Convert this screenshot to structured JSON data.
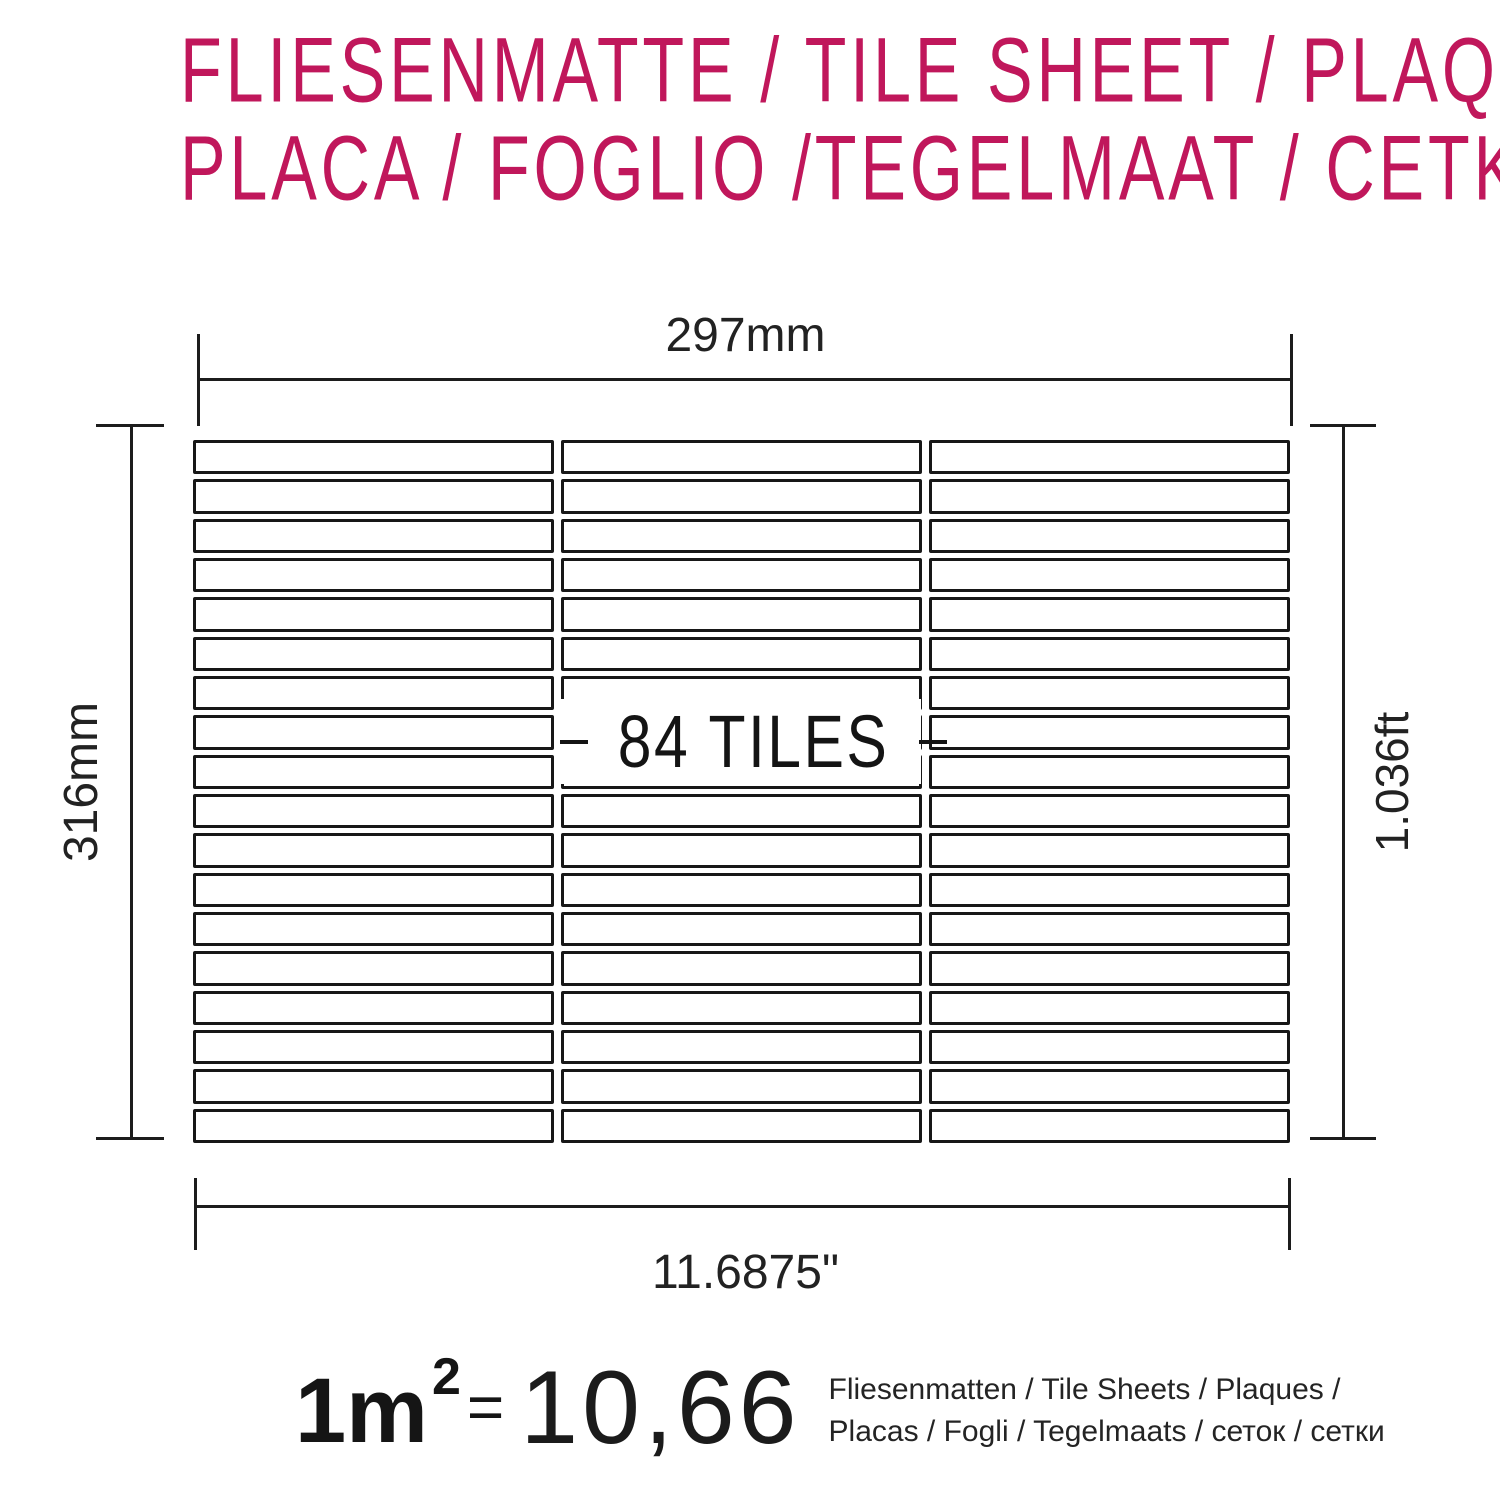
{
  "colors": {
    "title": "#c0175b",
    "line": "#1c1c1c"
  },
  "title": {
    "line1": "FLIESENMATTE / TILE SHEET / PLAQUE",
    "line2": "PLACA / FOGLIO /TEGELMAAT / CETKA"
  },
  "diagram": {
    "sheet_label": "84 TILES",
    "grid": {
      "drawn_rows": 18,
      "drawn_columns": 3
    },
    "dimensions": {
      "top": "297mm",
      "bottom": "11.6875\"",
      "left": "316mm",
      "right": "1.036ft"
    }
  },
  "conversion": {
    "area": "1m",
    "area_exponent": "2",
    "equals": "=",
    "value": "10,66",
    "units_line1": "Fliesenmatten / Tile Sheets /  Plaques /",
    "units_line2": "Placas / Fogli / Tegelmaats / сеток / сетки"
  }
}
